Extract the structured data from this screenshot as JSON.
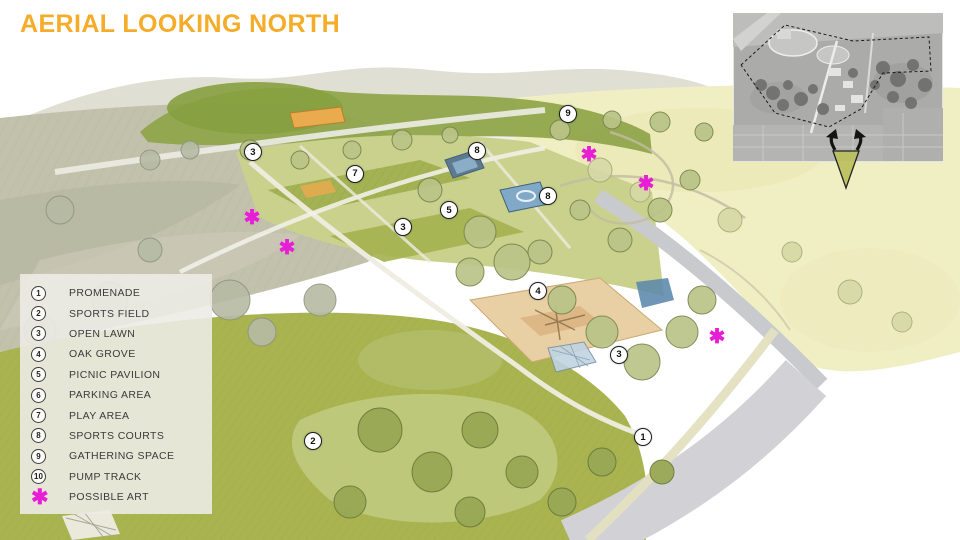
{
  "page": {
    "title": "AERIAL LOOKING NORTH"
  },
  "legend": {
    "items": [
      {
        "symbol": "1",
        "label": "PROMENADE",
        "type": "number"
      },
      {
        "symbol": "2",
        "label": "SPORTS FIELD",
        "type": "number"
      },
      {
        "symbol": "3",
        "label": "OPEN LAWN",
        "type": "number"
      },
      {
        "symbol": "4",
        "label": "OAK GROVE",
        "type": "number"
      },
      {
        "symbol": "5",
        "label": "PICNIC PAVILION",
        "type": "number"
      },
      {
        "symbol": "6",
        "label": "PARKING AREA",
        "type": "number"
      },
      {
        "symbol": "7",
        "label": "PLAY AREA",
        "type": "number"
      },
      {
        "symbol": "8",
        "label": "SPORTS COURTS",
        "type": "number"
      },
      {
        "symbol": "9",
        "label": "GATHERING SPACE",
        "type": "number"
      },
      {
        "symbol": "10",
        "label": "PUMP TRACK",
        "type": "number"
      },
      {
        "symbol": "✱",
        "label": "POSSIBLE ART",
        "type": "art"
      }
    ]
  },
  "map_markers": [
    {
      "number": "3",
      "x_pct": 26.35,
      "y_pct": 28.15
    },
    {
      "number": "7",
      "x_pct": 36.98,
      "y_pct": 32.22
    },
    {
      "number": "8",
      "x_pct": 49.69,
      "y_pct": 27.96
    },
    {
      "number": "5",
      "x_pct": 46.77,
      "y_pct": 38.89
    },
    {
      "number": "3",
      "x_pct": 41.98,
      "y_pct": 42.04
    },
    {
      "number": "8",
      "x_pct": 57.08,
      "y_pct": 36.3
    },
    {
      "number": "9",
      "x_pct": 59.17,
      "y_pct": 21.11
    },
    {
      "number": "4",
      "x_pct": 56.04,
      "y_pct": 53.89
    },
    {
      "number": "3",
      "x_pct": 64.48,
      "y_pct": 65.74
    },
    {
      "number": "1",
      "x_pct": 66.98,
      "y_pct": 80.93
    },
    {
      "number": "2",
      "x_pct": 32.6,
      "y_pct": 81.67
    }
  ],
  "art_markers": [
    {
      "x_pct": 26.25,
      "y_pct": 40.37
    },
    {
      "x_pct": 29.9,
      "y_pct": 45.93
    },
    {
      "x_pct": 61.35,
      "y_pct": 28.7
    },
    {
      "x_pct": 67.29,
      "y_pct": 34.07
    },
    {
      "x_pct": 74.69,
      "y_pct": 62.41
    }
  ],
  "icons": {
    "art_marker": "✱",
    "view_cone": "view-direction-cone"
  },
  "colors": {
    "title": "#F4AC29",
    "art_magenta": "#E81ED6",
    "legend_bg": "rgba(236,235,229,0.9)",
    "lawn_olive": "#A9B34F",
    "terrace_green": "#C9D18D",
    "meadow_yellow": "#F0EEC3",
    "meadow_taupe": "#C2C1AC",
    "road_gray": "#D2D2D6",
    "court_blue": "#7FA9C7",
    "sand_tan": "#E9CFA4"
  }
}
